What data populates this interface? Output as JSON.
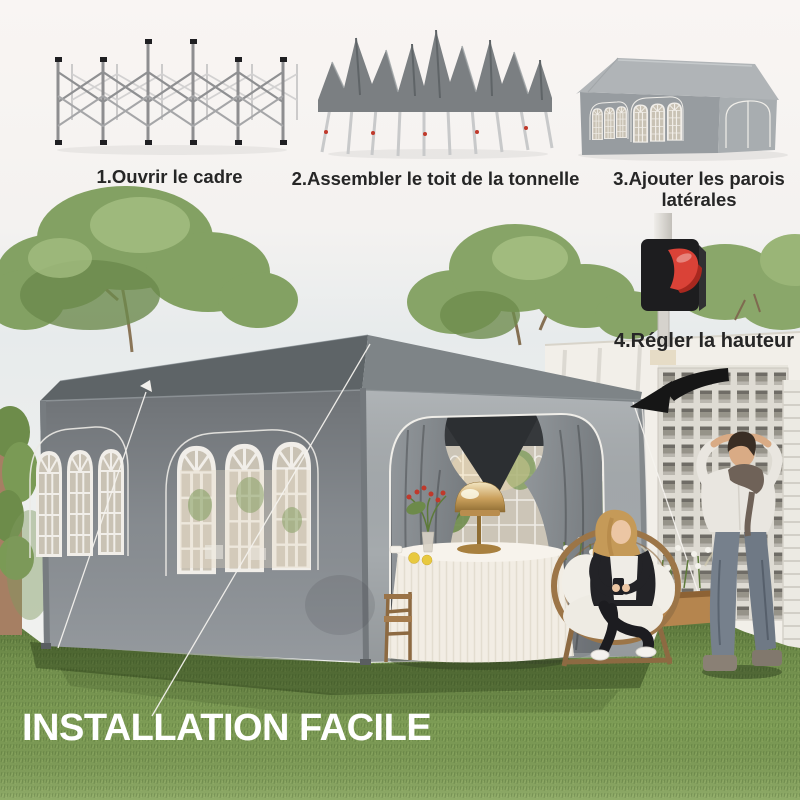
{
  "headline": {
    "text": "INSTALLATION FACILE"
  },
  "steps": [
    {
      "label": "1.Ouvrir le cadre",
      "figure": "folded-scissor-frame"
    },
    {
      "label": "2.Assembler le toit de la tonnelle",
      "figure": "canopy-draped-frame"
    },
    {
      "label": "3.Ajouter les parois latérales",
      "figure": "gazebo-with-sidewalls"
    },
    {
      "label": "4.Régler la hauteur",
      "figure": "height-adjuster-clip"
    }
  ],
  "colors": {
    "accent_red": "#da4237",
    "canopy_roof": "#5e6467",
    "canopy_wall": "#8d9297",
    "canopy_front": "#a5aaad",
    "grass_green": "#7d9c55",
    "caption_text": "#262626",
    "headline_white": "#ffffff",
    "arrow_black": "#161616"
  },
  "scene": {
    "subject": "grey-pop-up-gazebo-in-garden",
    "figures": [
      "woman-seated-in-round-rattan-chair",
      "man-standing-near-wall"
    ]
  }
}
